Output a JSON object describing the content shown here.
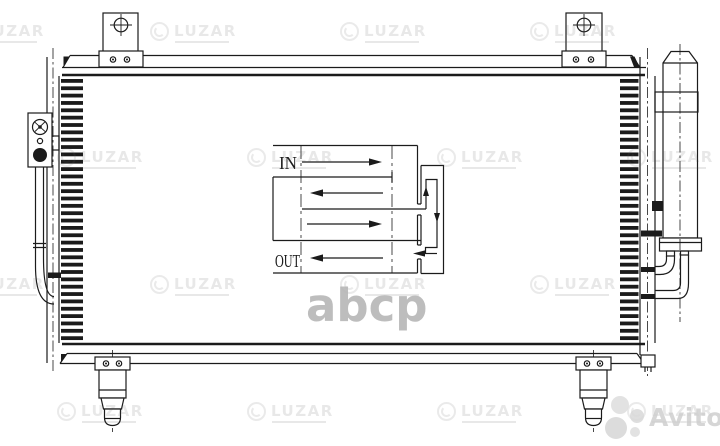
{
  "flow_diagram": {
    "in_label": "IN",
    "out_label": "OUT"
  },
  "watermarks": {
    "brand_text": "LUZAR",
    "catalog_text": "abcp",
    "marketplace_text": "Avito"
  },
  "colors": {
    "line": "#1b1b1b",
    "background": "#ffffff",
    "luzar_watermark_gray": "#8a8a8a",
    "abcp_watermark_gray": "#b5b5b5",
    "avito_watermark_gray": "#cfcfcf"
  }
}
